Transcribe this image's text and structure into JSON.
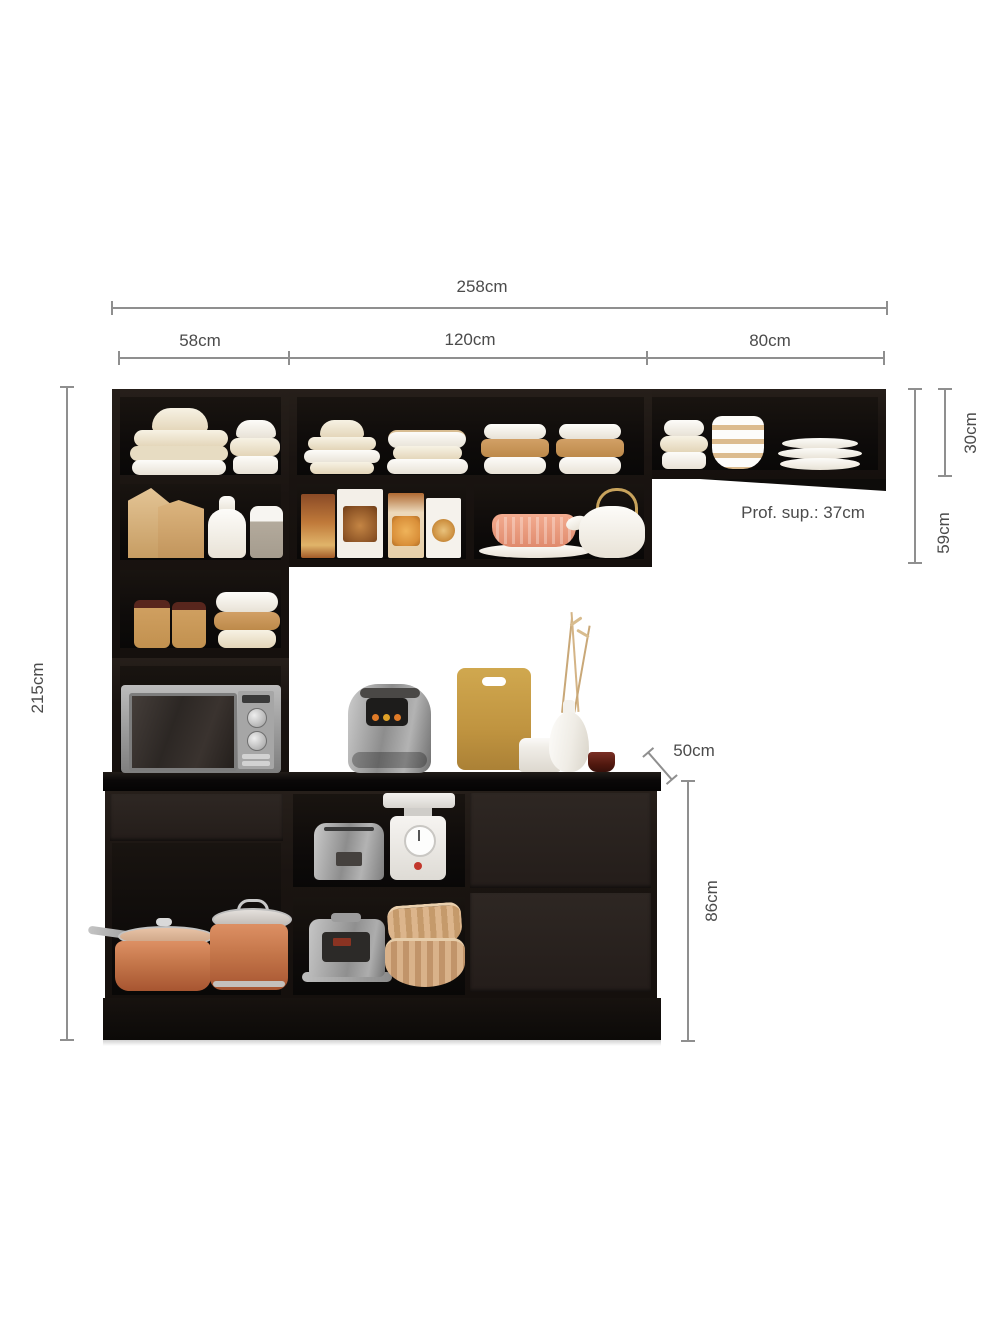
{
  "diagram": {
    "title_hint": "kitchen cabinet set dimension diagram",
    "labels": {
      "total_width": "258cm",
      "left_section_width": "58cm",
      "middle_section_width": "120cm",
      "right_section_width": "80cm",
      "right_upper_cabinet_height": "30cm",
      "upper_cabinet_height": "59cm",
      "upper_depth": "Prof. sup.: 37cm",
      "total_height": "215cm",
      "base_depth": "50cm",
      "base_height": "86cm"
    },
    "colors": {
      "background": "#ffffff",
      "cabinet_black": "#1a1411",
      "drawer_front": "#2a2320",
      "dimension_line": "#8f8f8f",
      "label_text": "#4b4b4b",
      "copper_pot": "#c4764a",
      "wood_tan": "#c9a24b",
      "dish_cream": "#efe6d0",
      "accent_salmon": "#ec9d82"
    },
    "objects": [
      "stacked-plates",
      "bowl-stack",
      "kraft-bags",
      "milk-bottle",
      "storage-canister",
      "kraft-jars",
      "banded-bowl-stacks",
      "food-boxes",
      "pink-bowl-on-plate",
      "teapot",
      "striped-bowl",
      "dish-stack",
      "microwave",
      "air-fryer",
      "cutting-board",
      "white-jar",
      "vase-with-dried-stems",
      "red-glass",
      "toaster",
      "kitchen-scale",
      "rice-cooker",
      "wooden-bowls",
      "copper-saucepan",
      "copper-pot",
      "drawers"
    ]
  }
}
